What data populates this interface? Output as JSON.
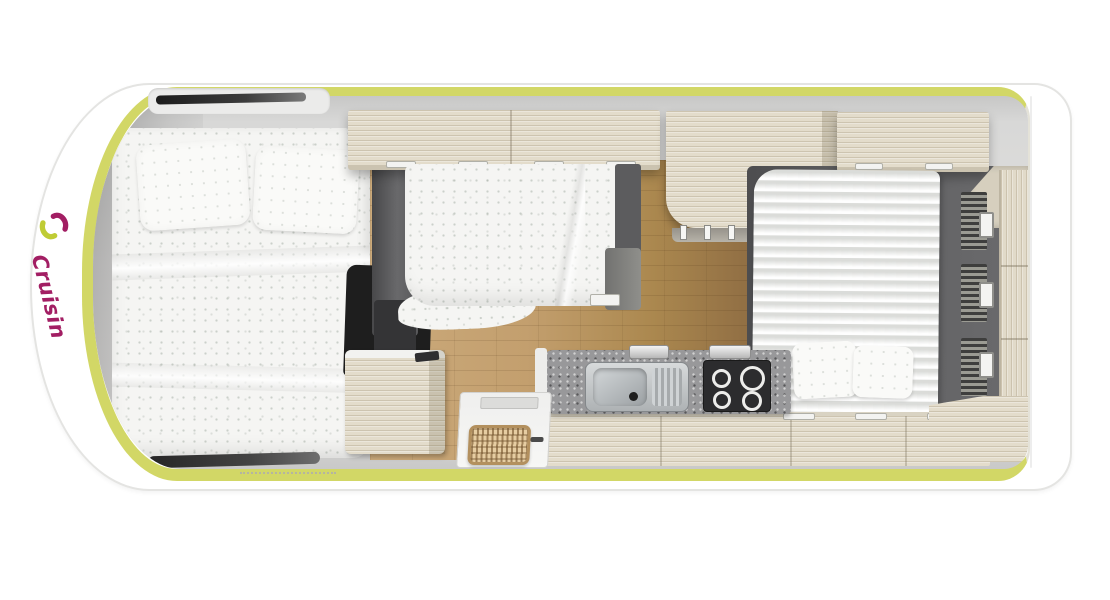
{
  "page": {
    "description": "Top-down 3D floor plan render of a Cruisin motorhome interior",
    "background": "#ffffff"
  },
  "brand": {
    "name": "Cruisin",
    "text_color": "#a21e63",
    "swirl_colors": [
      "#a21e63",
      "#bfcc35"
    ]
  },
  "vehicle": {
    "trim_color": "#d2d766",
    "body_color": "#ffffff",
    "areas": {
      "front_bed": {
        "label": "front-double-bed",
        "pillows": 2
      },
      "dinette_bed": {
        "label": "convertible-dinette-bed"
      },
      "rear_bed": {
        "label": "rear-double-bed",
        "pillows": 2
      },
      "kitchen": {
        "label": "kitchen",
        "features": [
          "stainless-sink",
          "four-burner-hob",
          "speckled-countertop"
        ]
      },
      "bathroom_unit": {
        "label": "bathroom-wardrobe-unit"
      },
      "entry": {
        "label": "entry-door-with-doormat"
      },
      "rear_wardrobe": {
        "label": "rear-wardrobe-drawers",
        "handles": 3
      },
      "overhead_lockers": {
        "label": "overhead-lockers"
      },
      "skylight": {
        "label": "cab-skylight"
      }
    },
    "colors": {
      "cabinet_wood": "#e3dccb",
      "floor_wood": "#bf9a6a",
      "upholstery_dark": "#565658",
      "bedding_white": "#f5f5f3",
      "countertop_gray": "#98989a",
      "hob_black": "#2c2c2e",
      "interior_gray": "#dedddc"
    }
  }
}
